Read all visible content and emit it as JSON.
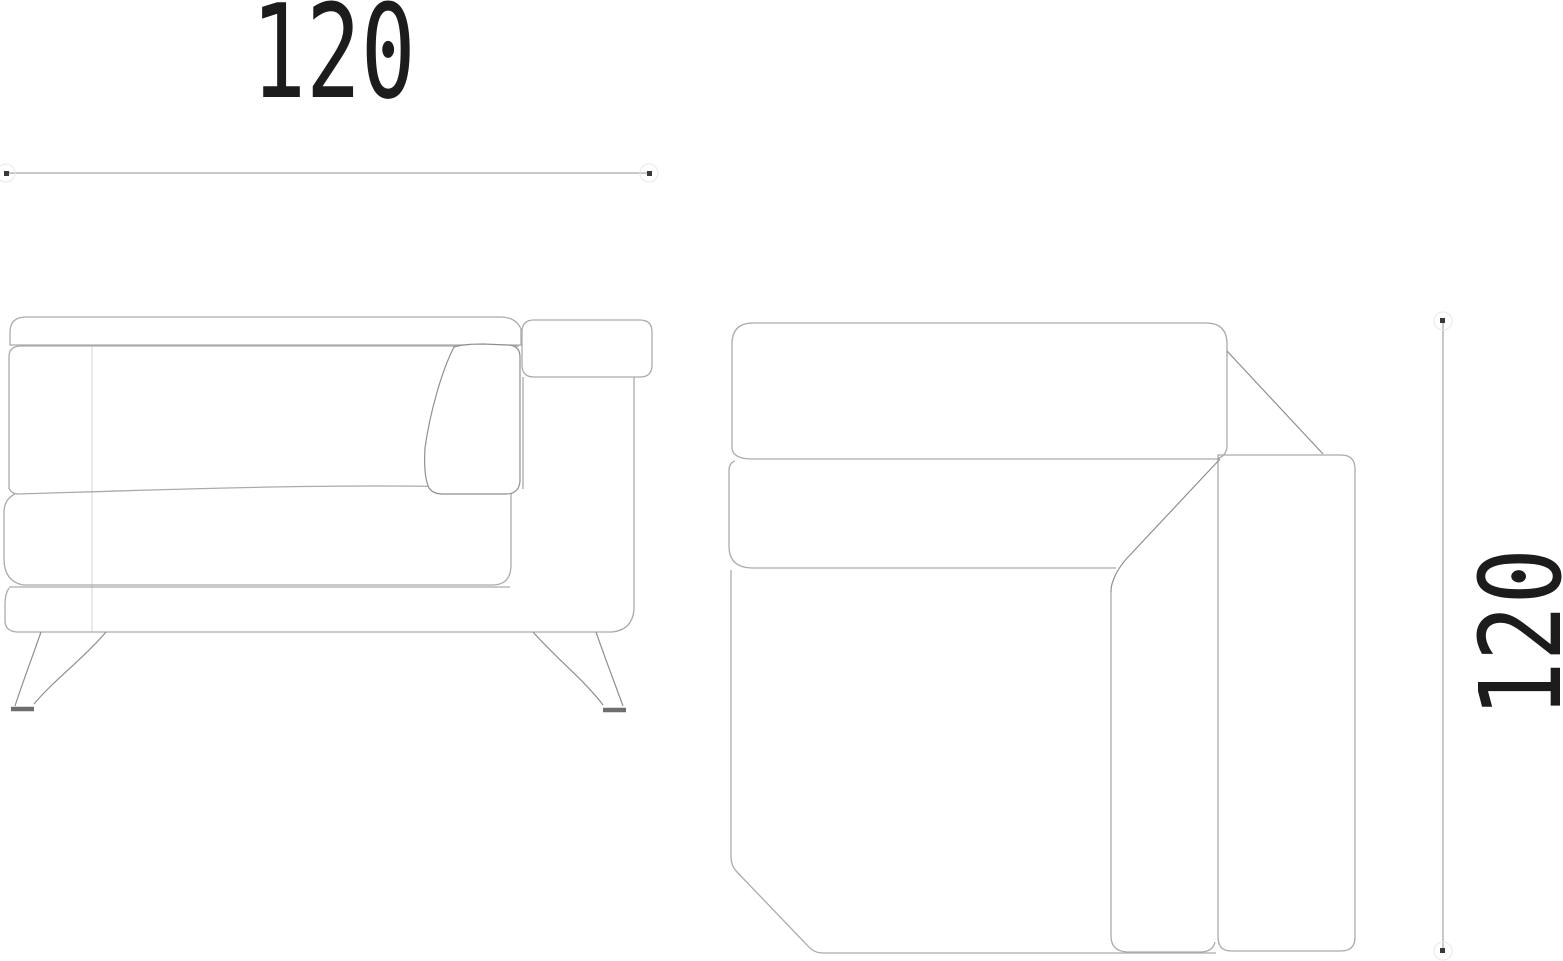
{
  "drawing": {
    "type": "furniture-technical-drawing",
    "views": [
      "side-elevation",
      "plan-view"
    ]
  },
  "dimensions": {
    "top": {
      "label": "120"
    },
    "right": {
      "label": "120"
    }
  },
  "colors": {
    "background": "#ffffff",
    "outline": "#ababab",
    "outline_dark": "#8f8f8f",
    "seam": "#d8d8d8",
    "dimension_line": "#c8c8c8",
    "tick": "#383838",
    "text": "#1c1c1c"
  }
}
